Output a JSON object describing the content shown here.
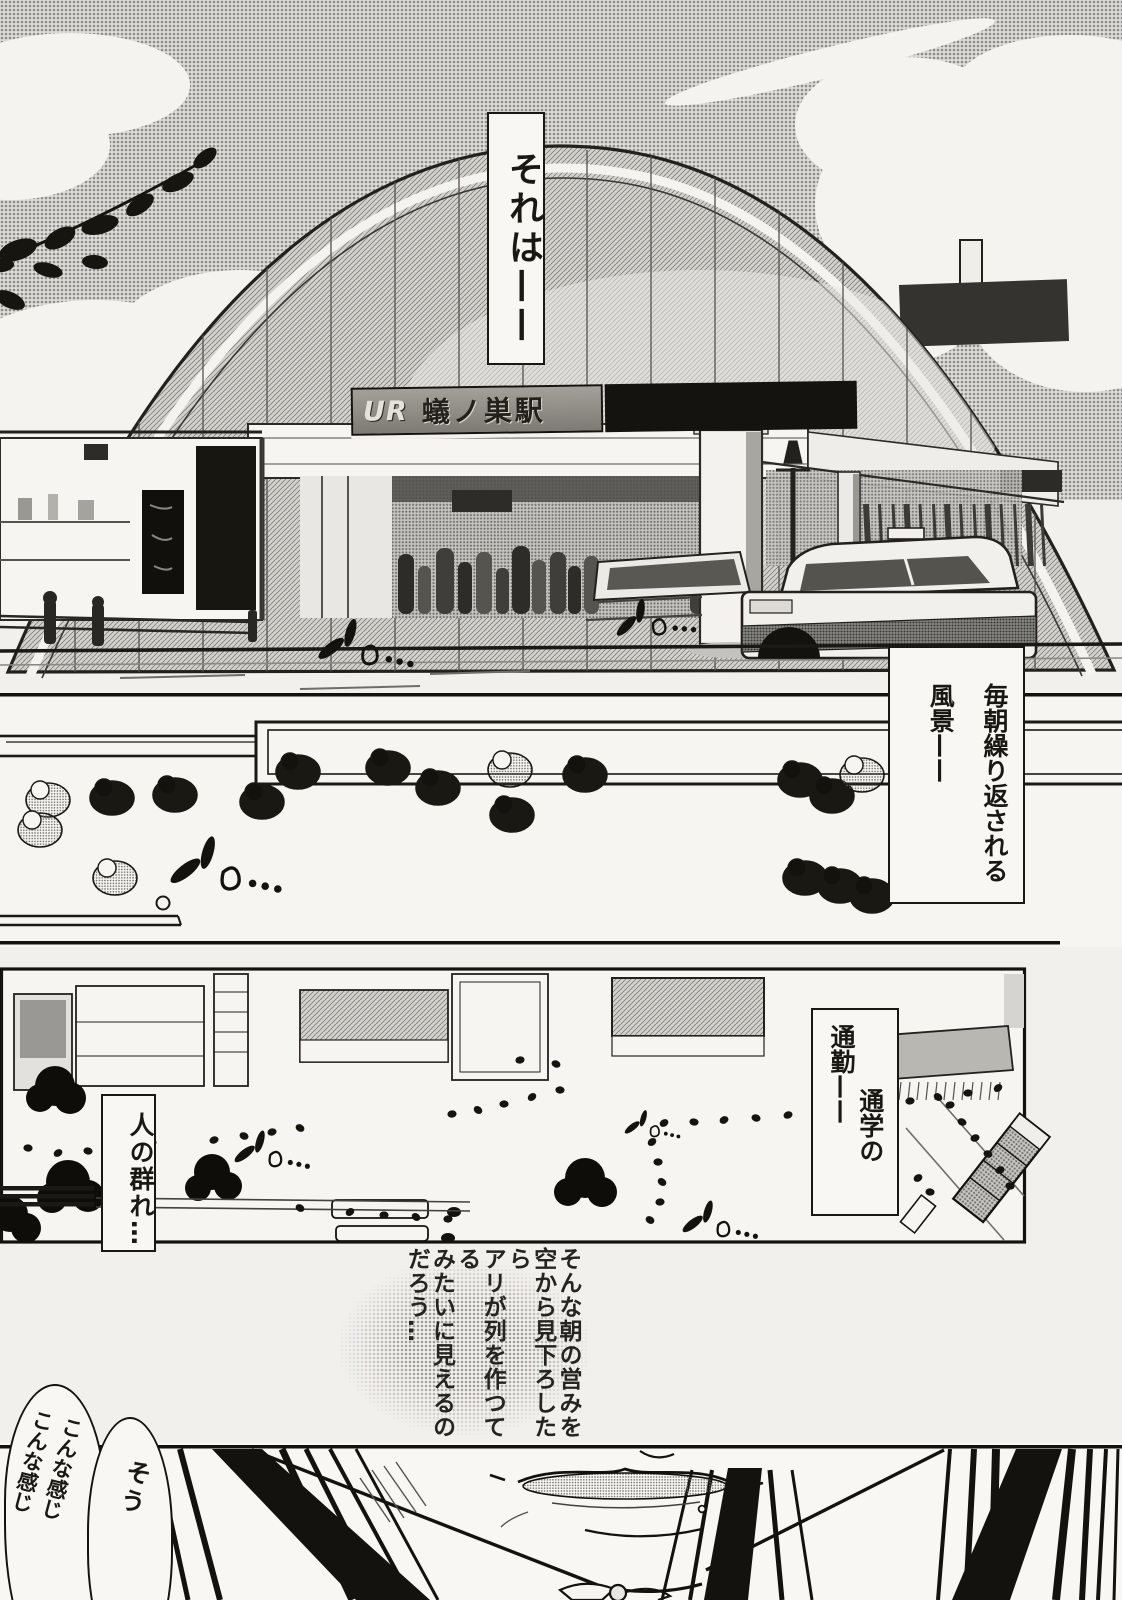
{
  "colors": {
    "paper": "#f2f0ed",
    "ink": "#1a1813",
    "sky_halftone": "#b3b1ad",
    "sign_bg": "#8f8c86",
    "sign_text_dark": "#23211b",
    "sign_text_light": "#e4e2db"
  },
  "panel_station": {
    "caption_intro": "それは——",
    "station_sign": {
      "operator": "UR",
      "name": "蟻ノ巣駅"
    }
  },
  "panel_crowd_overhead": {
    "caption_morning": "毎朝繰り返される\n風景——"
  },
  "panel_aerial": {
    "caption_commute_line1": "通勤——",
    "caption_commute_line2": "通学の",
    "caption_crowd": "人の群れ…"
  },
  "gutter_narration": {
    "text": "そんな朝の営みを\n空から見下ろしたら\nアリが列を作つてる\nみたいに見えるの\nだろう…"
  },
  "panel_face": {
    "bubble_sou": "そう",
    "bubble_konna": "こんな感じ\nこんな感じ"
  }
}
